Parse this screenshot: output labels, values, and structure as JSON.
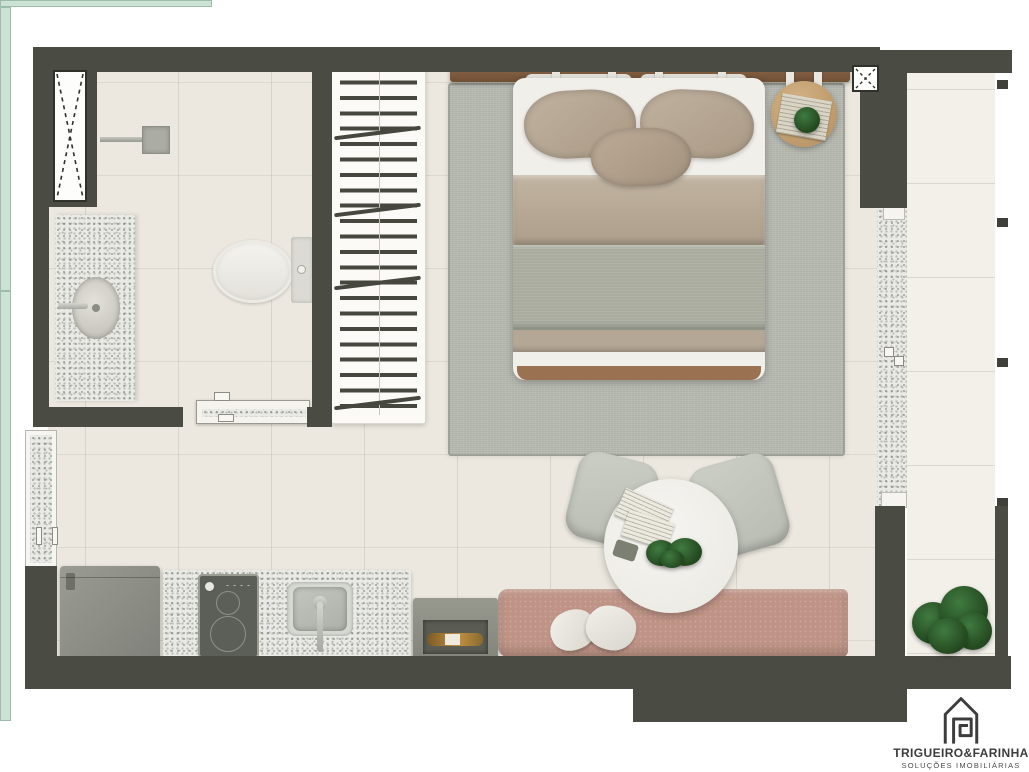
{
  "brand": {
    "name": "TRIGUEIRO&FARINHA",
    "tagline": "SOLUÇÕES IMOBILIÁRIAS"
  },
  "palette": {
    "wall": "#4a4b43",
    "floor": "#ece8df",
    "balcony_floor": "#f2f0e9",
    "rug": "#b8bbb2",
    "glass": "#cbe2d4",
    "bench": "#bf9486",
    "bed_duvet": "#b5a893",
    "bed_blanket": "#a9ac9f",
    "headboard_wood": "#7d5a3e",
    "nightstand_wood": "#c9a97b",
    "plant_green": "#2f5c29",
    "cooktop": "#5c5f57",
    "fridge": "#8f9088",
    "logo_ink": "#3c3c3c"
  },
  "plan": {
    "type": "studio apartment floor plan (top view render)",
    "rooms": [
      "bathroom",
      "closet",
      "bedroom",
      "kitchen",
      "dining area",
      "balcony"
    ],
    "furniture": [
      "shower",
      "washbasin-counter",
      "toilet",
      "wardrobe-hangers",
      "double-bed",
      "round-nightstand",
      "area-rug",
      "refrigerator",
      "two-burner-cooktop",
      "kitchen-sink",
      "wine-crate",
      "banquette-bench",
      "round-dining-table",
      "two-chairs",
      "balcony-plant",
      "glass-railing",
      "sliding-glass-door",
      "bathroom-sliding-door",
      "service-window",
      "vent-shafts"
    ]
  }
}
